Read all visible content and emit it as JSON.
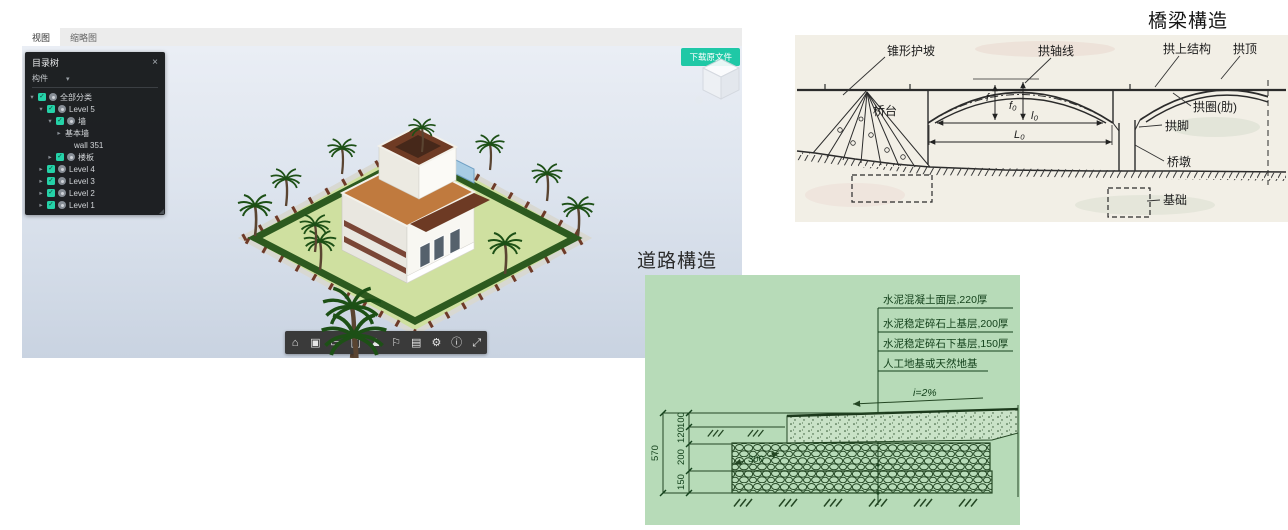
{
  "viewer": {
    "tabs": [
      {
        "label": "视图"
      },
      {
        "label": "缩略图"
      }
    ],
    "download_button_label": "下载原文件",
    "accent_teal": "#1fc8a6",
    "tree_panel": {
      "title": "目录树",
      "close": "×",
      "filter_label": "构件",
      "items": [
        {
          "label": "全部分类",
          "depth": 0,
          "arrow": "▾",
          "checkbox": true,
          "eye": true
        },
        {
          "label": "Level 5",
          "depth": 1,
          "arrow": "▾",
          "checkbox": true,
          "eye": true
        },
        {
          "label": "墙",
          "depth": 2,
          "arrow": "▾",
          "checkbox": true,
          "eye": true
        },
        {
          "label": "基本墙",
          "depth": 3,
          "arrow": "▸",
          "checkbox": false,
          "eye": false
        },
        {
          "label": "wall 351",
          "depth": 4,
          "arrow": "",
          "checkbox": false,
          "eye": false
        },
        {
          "label": "楼板",
          "depth": 2,
          "arrow": "▸",
          "checkbox": true,
          "eye": true
        },
        {
          "label": "Level 4",
          "depth": 1,
          "arrow": "▸",
          "checkbox": true,
          "eye": true
        },
        {
          "label": "Level 3",
          "depth": 1,
          "arrow": "▸",
          "checkbox": true,
          "eye": true
        },
        {
          "label": "Level 2",
          "depth": 1,
          "arrow": "▸",
          "checkbox": true,
          "eye": true
        },
        {
          "label": "Level 1",
          "depth": 1,
          "arrow": "▸",
          "checkbox": true,
          "eye": true
        }
      ]
    },
    "toolbar": {
      "icons": [
        {
          "name": "home-icon",
          "glyph": "⌂"
        },
        {
          "name": "snapshot-icon",
          "glyph": "▣"
        },
        {
          "name": "measure-icon",
          "glyph": "▭"
        },
        {
          "name": "section-icon",
          "glyph": "◫"
        },
        {
          "name": "walkthrough-icon",
          "glyph": "♟"
        },
        {
          "name": "roam-icon",
          "glyph": "⚐"
        },
        {
          "name": "properties-icon",
          "glyph": "▤"
        },
        {
          "name": "settings-icon",
          "glyph": "⚙"
        },
        {
          "name": "info-icon",
          "glyph": "ⓘ"
        },
        {
          "name": "fullscreen-icon",
          "glyph": "⤢"
        }
      ]
    }
  },
  "bridge": {
    "title": "橋梁構造",
    "labels": {
      "cone_slope": "锥形护坡",
      "arch_axis": "拱轴线",
      "arch_superstructure": "拱上结构",
      "arch_crown": "拱顶",
      "abutment": "桥台",
      "arch_ring": "拱圈(肋)",
      "arch_foot": "拱脚",
      "pier": "桥墩",
      "foundation": "基础",
      "dim_f": "f",
      "dim_f0": "f₀",
      "dim_l0": "l₀",
      "dim_L0": "L₀"
    }
  },
  "road": {
    "title": "道路構造",
    "background": "#b7dbb8",
    "layer_labels": [
      "水泥混凝土面层,220厚",
      "水泥稳定碎石上基层,200厚",
      "水泥稳定碎石下基层,150厚",
      "人工地基或天然地基"
    ],
    "slope_label": "i=2%",
    "dims": {
      "total": "570",
      "d1": "100",
      "d2": "120",
      "d3": "200",
      "d4": "150",
      "width_note": "300"
    }
  }
}
